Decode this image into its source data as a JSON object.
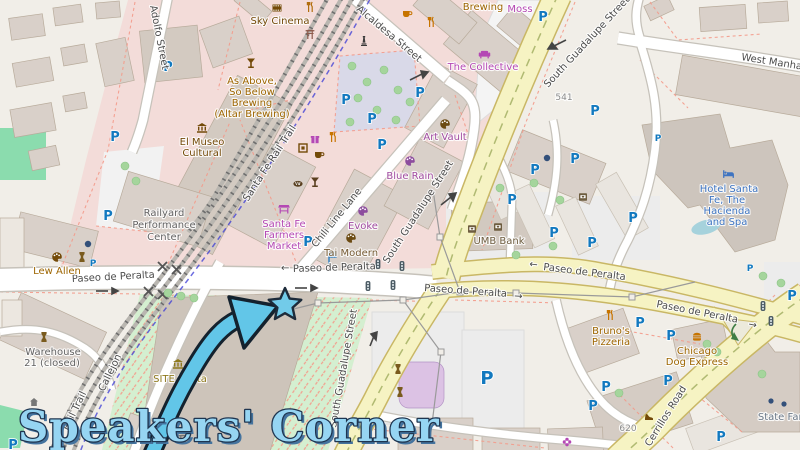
{
  "annotation": {
    "text": "Speakers' Corner"
  },
  "glyphs": {
    "parking": "P",
    "arrow_left": "←",
    "arrow_right": "→"
  },
  "streets": {
    "adolfo": "Adolfo Street",
    "alcaldesa": "Alcaldesa Street",
    "rail_trail_full": "Santa Fe Rail Trail",
    "chili": "Chili Line Lane",
    "guadalupe": "South Guadalupe Street",
    "paseo": "Paseo de Peralta",
    "manhattan": "West Manhattan",
    "cerrillos": "Cerrillos Road",
    "rail_trail_short": "Rail Trail",
    "callejon": "Callejon"
  },
  "pois": {
    "sky_cinema": {
      "label": "Sky Cinema"
    },
    "altar_brewing": {
      "lines": [
        "As Above,",
        "So Below",
        "Brewing",
        "(Altar Brewing)"
      ]
    },
    "brewing_fragment": {
      "label": "Brewing"
    },
    "moss": {
      "label": "Moss"
    },
    "collective": {
      "label": "The Collective"
    },
    "el_museo": {
      "lines": [
        "El Museo",
        "Cultural"
      ]
    },
    "railyard_pc": {
      "lines": [
        "Railyard",
        "Performance",
        "Center"
      ]
    },
    "farmers_market": {
      "lines": [
        "Santa Fe",
        "Farmers",
        "Market"
      ]
    },
    "evoke": {
      "label": "Evoke"
    },
    "tai_modern": {
      "label": "Tai Modern"
    },
    "blue_rain": {
      "label": "Blue Rain"
    },
    "art_vault": {
      "label": "Art Vault"
    },
    "lew_allen": {
      "label": "Lew Allen"
    },
    "hotel_santa_fe": {
      "lines": [
        "Hotel Santa",
        "Fe, The",
        "Hacienda",
        "and Spa"
      ]
    },
    "umb_bank": {
      "label": "UMB Bank"
    },
    "warehouse21": {
      "lines": [
        "Warehouse",
        "21 (closed)"
      ]
    },
    "site_santa_fe": {
      "lines": [
        "SITE Santa",
        "Fe"
      ]
    },
    "brunos": {
      "lines": [
        "Bruno's",
        "Pizzeria"
      ]
    },
    "chicago_dog": {
      "lines": [
        "Chicago",
        "Dog Express"
      ]
    },
    "state_farm": {
      "label": "State Farm"
    }
  },
  "numbers": {
    "b541": "541",
    "b620": "620"
  },
  "colors": {
    "annotation_fill": "#96d5f2",
    "annotation_outline": "#1f3550",
    "star_fill": "#72cbe9",
    "road_primary": "#f6f3c3",
    "park": "#d4efd0",
    "building": "#d9d0c9",
    "lavender_lot": "#d9d9e8",
    "shop": "#b448b4",
    "gallery": "#a04ba0",
    "amenity_brown": "#734a08",
    "hotel_blue": "#3e74c1",
    "parking_blue": "#1279bf",
    "water": "#a6d2dc"
  }
}
